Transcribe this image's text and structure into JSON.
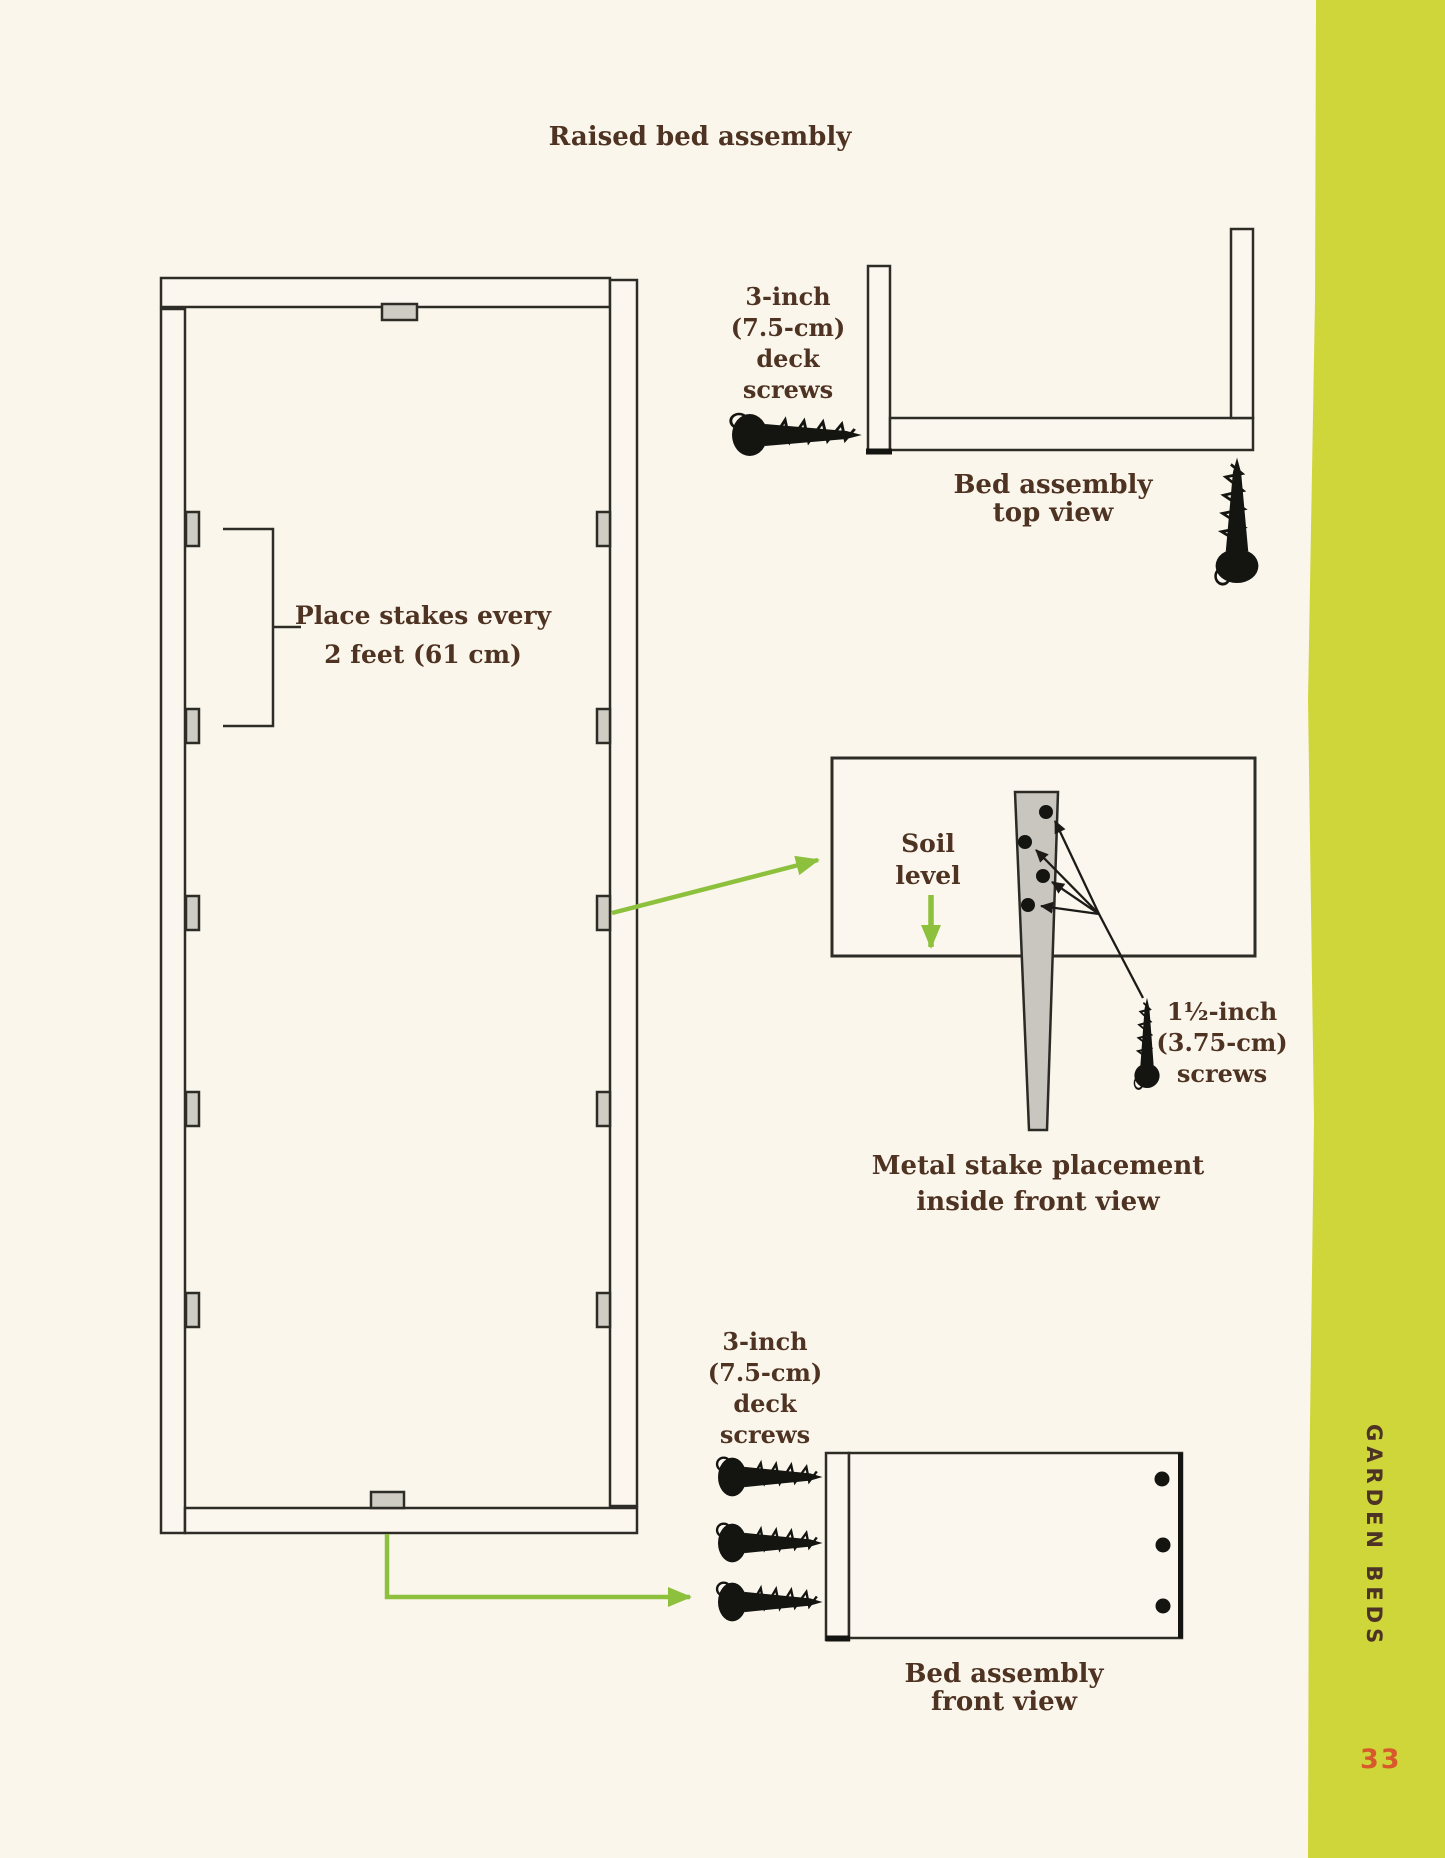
{
  "page": {
    "title": "Raised bed assembly",
    "sidebar": {
      "label": "GARDEN BEDS",
      "page_number": "33"
    }
  },
  "diagrams": {
    "bed_plan_top_view": {
      "stake_note": "Place stakes every\n2 feet (61 cm)"
    },
    "corner_top_view": {
      "screw_label": "3-inch\n(7.5-cm)\ndeck\nscrews",
      "caption": "Bed assembly\ntop view"
    },
    "stake_detail": {
      "soil_label": "Soil\nlevel",
      "screw_label": "1½-inch\n(3.75-cm)\nscrews",
      "caption": "Metal stake placement\ninside front view"
    },
    "front_view": {
      "screw_label": "3-inch\n(7.5-cm)\ndeck\nscrews",
      "caption": "Bed assembly\nfront view"
    }
  },
  "colors": {
    "background": "#faf6ec",
    "ink": "#2e2c26",
    "text_brown": "#4f3322",
    "arrow_green": "#8dc03c",
    "sidebar_green": "#cfd63a",
    "page_number_orange": "#d8592c",
    "stake_gray": "#cfccc4"
  }
}
